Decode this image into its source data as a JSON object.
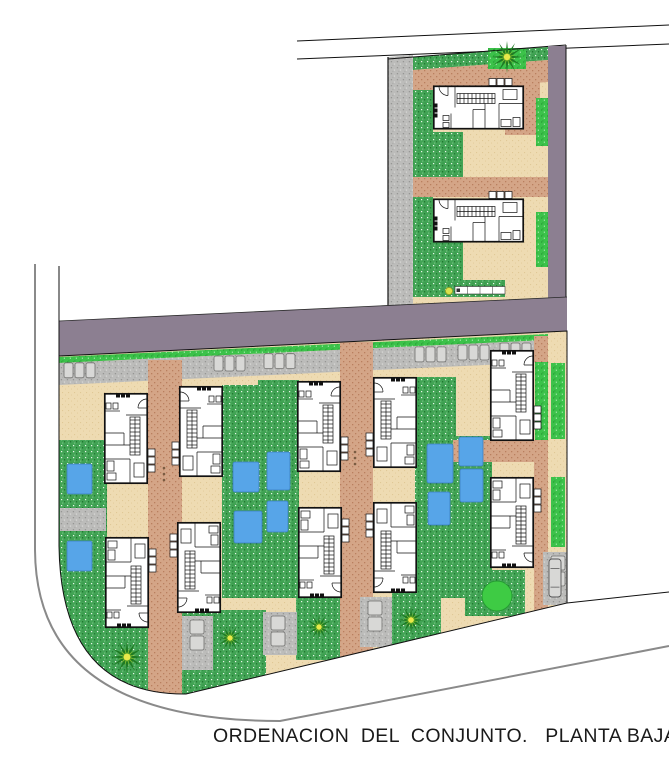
{
  "caption": {
    "text": "ORDENACION  DEL  CONJUNTO.   PLANTA BAJA"
  },
  "plan": {
    "colors": {
      "road": "#8c7f91",
      "wall": "#111111",
      "house_fill": "#ffffff",
      "lawn": "#42a455",
      "lawn_dark": "#1b6e2a",
      "lawn_light": "#e8f5e9",
      "hedge": "#3cc24a",
      "hedge_dark": "#259a33",
      "pool": "#57a5e8",
      "pool_edge": "#3c7fc0",
      "terrace": "#eedbb2",
      "terrace_dot": "#e0c896",
      "path": "#d4a587",
      "path_dot": "#b97f5f",
      "paving": "#bcbcba",
      "paving_dot": "#969694",
      "car_fill": "#d8d8d6",
      "car_line": "#555555",
      "palm_frond": "#1f7a23",
      "palm_mid": "#7ab82e",
      "palm_center": "#e8e84a",
      "bush": "#3ecb44",
      "boundary_gray": "#8a8a8a",
      "scale_dot": "#d9e24c"
    },
    "features": {
      "villas_upper_block": 2,
      "villas_lower_block": 10,
      "swimming_pools": 12,
      "palm_trees": 5,
      "parked_cars": 4
    }
  }
}
